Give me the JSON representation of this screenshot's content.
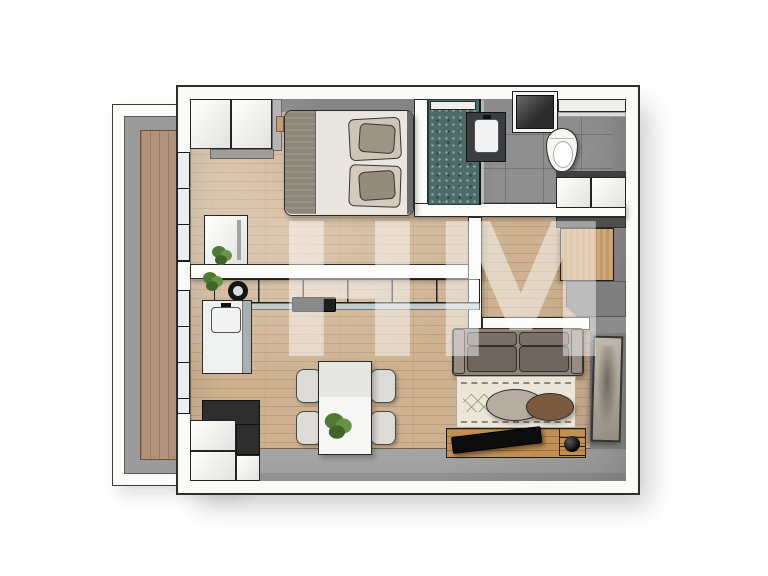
{
  "watermark": {
    "text": "HM"
  },
  "palette": {
    "background": "#ffffff",
    "wall_white": "#fafaf9",
    "wall_outline": "#2e2e2e",
    "inner_wall_gray": "#9b9b9b",
    "wood_floor": "#cdb190",
    "balcony_wood": "#b3937a",
    "concrete_floor": "#a6a6a6",
    "bath_tile": "#8f8f8f",
    "shower_floor": "#4d6b66",
    "sofa_gray": "#8d8379",
    "rug_cream": "#ece6d8",
    "console_wood": "#c29053",
    "coffee_table_taupe": "#b6aca2",
    "coffee_table_brown": "#7c5a40",
    "plant_green": "#4e7a33"
  }
}
